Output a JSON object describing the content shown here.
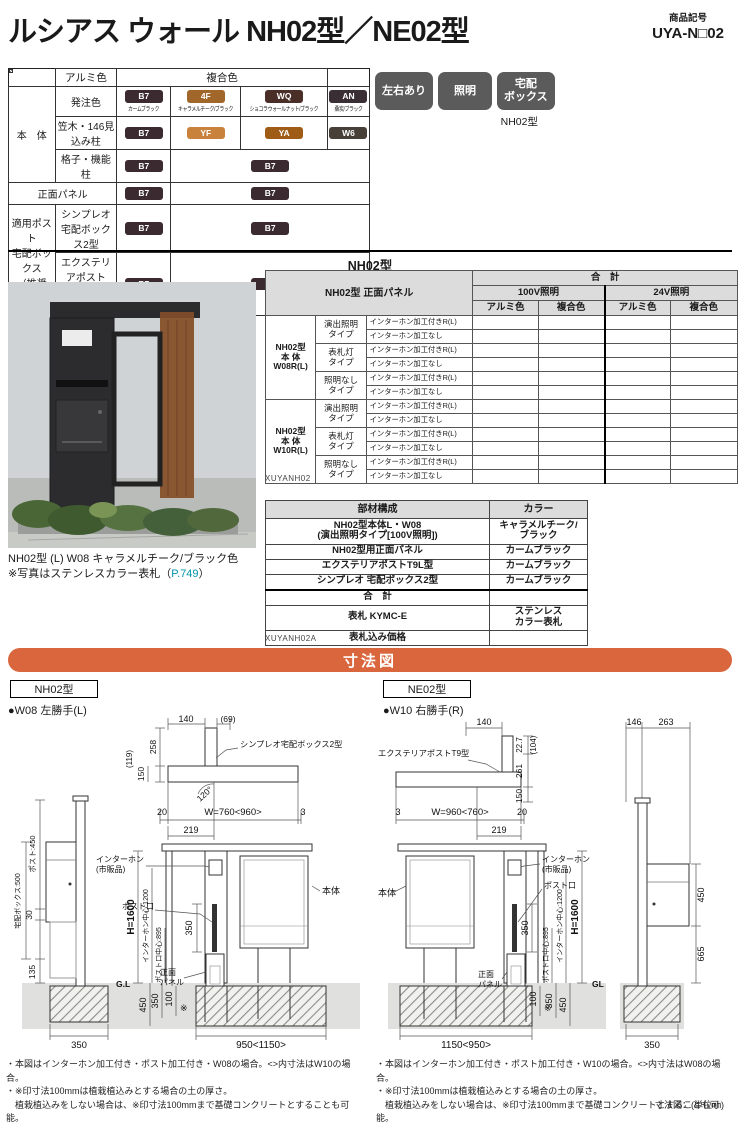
{
  "header": {
    "title": "ルシアス ウォール NH02型／NE02型",
    "product_code_label": "商品記号",
    "product_code": "UYA-N□02"
  },
  "badges": {
    "b1": "左右あり",
    "b2": "照明",
    "b3": "宅配\nボックス",
    "model": "NH02型"
  },
  "color_table": {
    "header": {
      "alumi": "アルミ色",
      "fukugo": "複合色"
    },
    "group_body": "本　体",
    "group_post": "適用ポスト\n宅配ボックス\n（推奨色）",
    "rows": {
      "order": {
        "label": "発注色",
        "alumi": {
          "code": "B7",
          "name": "カームブラック",
          "hex": "#3b2a30"
        },
        "f1": {
          "code": "4F",
          "name": "キャラメルチーク/ブラック",
          "hex": "#a0662a"
        },
        "f2": {
          "code": "WQ",
          "name": "ショコラウォールナット/ブラック",
          "hex": "#4a2f28"
        },
        "f3": {
          "code": "AN",
          "name": "桑炭/ブラック",
          "hex": "#392e34"
        }
      },
      "kasagi": {
        "label": "笠木・146見込み柱",
        "alumi": {
          "code": "B7",
          "hex": "#3b2a30"
        },
        "f1": {
          "code": "YF",
          "hex": "#c8823b"
        },
        "f2": {
          "code": "YA",
          "hex": "#9e5c17"
        },
        "f3": {
          "code": "W6",
          "hex": "#474039"
        }
      },
      "koshi": {
        "label": "格子・機能柱",
        "alumi": {
          "code": "B7",
          "hex": "#3b2a30"
        },
        "f": {
          "code": "B7",
          "hex": "#3b2a30"
        }
      },
      "panel": {
        "label": "正面パネル",
        "alumi": {
          "code": "B7",
          "hex": "#3b2a30"
        },
        "f": {
          "code": "B7",
          "hex": "#3b2a30"
        }
      },
      "simpleo": {
        "label": "シンプレオ\n宅配ボックス2型",
        "alumi": {
          "code": "B7",
          "hex": "#3b2a30"
        },
        "f": {
          "code": "B7",
          "hex": "#3b2a30"
        }
      },
      "exterior": {
        "label": "エクステリアポスト\nT9型、T9R (L) 型",
        "alumi": {
          "code": "B7",
          "hex": "#3b2a30"
        },
        "f": {
          "code": "B7",
          "hex": "#3b2a30"
        }
      }
    }
  },
  "section": {
    "model_header": "NH02型"
  },
  "photo": {
    "caption_line1": "NH02型 (L) W08 キャラメルチーク/ブラック色",
    "caption_prefix": "※写真はステンレスカラー表札（",
    "caption_link": "P.749",
    "caption_suffix": "）"
  },
  "price_table": {
    "corner": "NH02型 正面パネル",
    "total": "合　計",
    "v100": "100V照明",
    "v24": "24V照明",
    "alumi": "アルミ色",
    "fukugo": "複合色",
    "groups": [
      {
        "name": "NH02型\n本 体\nW08R(L)"
      },
      {
        "name": "NH02型\n本 体\nW10R(L)"
      }
    ],
    "types": [
      "演出照明\nタイプ",
      "表札灯\nタイプ",
      "照明なし\nタイプ"
    ],
    "sub_with": "インターホン加工付きR(L)",
    "sub_without": "インターホン加工なし",
    "code": "XUYANH02"
  },
  "parts_table": {
    "h_name": "部材構成",
    "h_color": "カラー",
    "rows": [
      {
        "name": "NH02型本体L・W08\n(演出照明タイプ[100V照明])",
        "color": "キャラメルチーク/\nブラック"
      },
      {
        "name": "NH02型用正面パネル",
        "color": "カームブラック"
      },
      {
        "name": "エクステリアポストT9L型",
        "color": "カームブラック"
      },
      {
        "name": "シンプレオ 宅配ボックス2型",
        "color": "カームブラック"
      },
      {
        "name": "合　計",
        "color": ""
      },
      {
        "name": "表札 KYMC-E",
        "color": "ステンレス\nカラー表札"
      },
      {
        "name": "表札込み価格",
        "color": ""
      }
    ],
    "code": "XUYANH02A"
  },
  "dims": {
    "banner": "寸法図",
    "unit_note": "寸法図：(単位㎜)",
    "left": {
      "model": "NH02型",
      "handing": "●W08 左勝手(L)",
      "plan": {
        "d140": "140",
        "d69": "(69)",
        "label": "シンプレオ宅配ボックス2型",
        "d258": "258",
        "d150": "150",
        "d119": "(119)",
        "angle": "120°"
      },
      "w20": "20",
      "w": "W=760<960>",
      "w3": "3",
      "d219": "219",
      "elev": {
        "intercom1": "インターホン",
        "intercom2": "(市販品)",
        "slot": "ポスト口",
        "body": "本体",
        "panel1": "正面",
        "panel2": "パネル",
        "h": "H=1600",
        "c1200": "インターホン中心:1200",
        "c895": "ポスト口中心:895",
        "d350": "350",
        "gl": "G.L",
        "u450": "450",
        "u350": "350",
        "u100": "100",
        "mark": "※",
        "wbase": "950<1150>"
      },
      "side": {
        "post450": "ポスト:450",
        "d30": "30",
        "box500": "宅配ボックス:500",
        "d135": "135",
        "d350": "350"
      }
    },
    "right": {
      "model": "NE02型",
      "handing": "●W10 右勝手(R)",
      "plan": {
        "label": "エクステリアポストT9型",
        "d140": "140",
        "d227": "22.7",
        "d104": "(104)",
        "d261": "261",
        "d150": "150"
      },
      "w3": "3",
      "w": "W=960<760>",
      "w20": "20",
      "d219": "219",
      "elev": {
        "intercom1": "インターホン",
        "intercom2": "(市販品)",
        "slot": "ポスト口",
        "body": "本体",
        "panel1": "正面",
        "panel2": "パネル",
        "h": "H=1600",
        "c1200": "インターホン中心:1200",
        "c895": "ポスト口中心:895",
        "d350": "350",
        "gl": "GL",
        "u450": "450",
        "u350": "350",
        "u100": "100",
        "mark": "※",
        "wbase": "1150<950>"
      },
      "side": {
        "d146": "146",
        "d263": "263",
        "d450": "450",
        "d665": "665",
        "d350": "350"
      }
    },
    "notes_left": [
      "・本図はインターホン加工付き・ポスト加工付き・W08の場合。<>内寸法はW10の場合。",
      "・※印寸法100mmは植栽植込みとする場合の土の厚さ。",
      "　植栽植込みをしない場合は、※印寸法100mmまで基礎コンクリートとすることも可能。",
      "　この場合、基礎コンクリート深さは450mm(350mm+100mm)"
    ],
    "notes_right": [
      "・本図はインターホン加工付き・ポスト加工付き・W10の場合。<>内寸法はW08の場合。",
      "・※印寸法100mmは植栽植込みとする場合の土の厚さ。",
      "　植栽植込みをしない場合は、※印寸法100mmまで基礎コンクリートとすることも可能。",
      "　この場合、基礎コンクリート深さは450mm(350mm+100mm)"
    ]
  }
}
